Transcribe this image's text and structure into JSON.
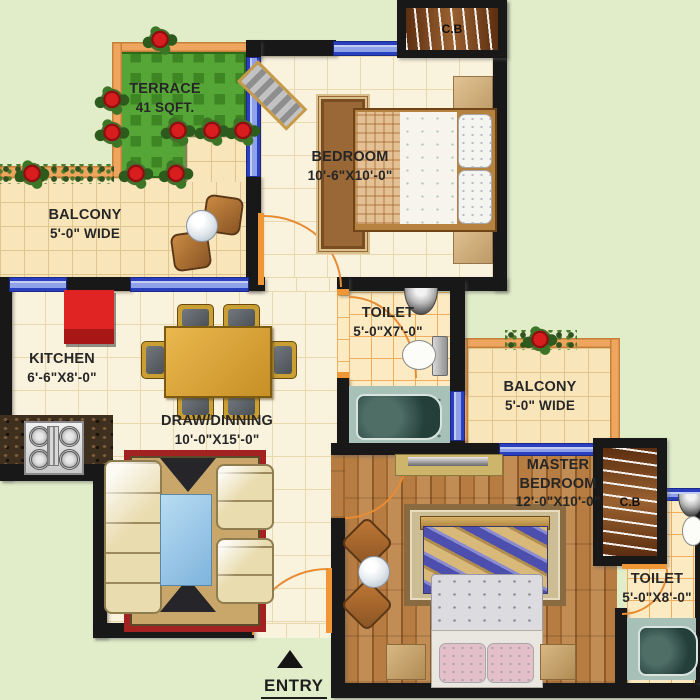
{
  "title": "apartment-floor-plan",
  "colors": {
    "background": "#e1edc9",
    "wall": "#181818",
    "outer_wall_orange": "#f0a55e",
    "window_blue": "#2a3fbe",
    "door_swing_orange": "#e88c34",
    "grass_green": "#56a637",
    "carpet_red_border": "#a32121",
    "floor_cream": "#f9f2dd",
    "wood_floor": "#b67c41"
  },
  "rooms": {
    "terrace": {
      "name": "TERRACE",
      "size": "41 SQFT."
    },
    "balcony_left": {
      "name": "BALCONY",
      "size": "5'-0\" WIDE"
    },
    "bedroom": {
      "name": "BEDROOM",
      "size": "10'-6\"X10'-0\""
    },
    "toilet_top": {
      "name": "TOILET",
      "size": "5'-0\"X7'-0\""
    },
    "kitchen": {
      "name": "KITCHEN",
      "size": "6'-6\"X8'-0\""
    },
    "draw_dining": {
      "name": "DRAW/DINNING",
      "size": "10'-0\"X15'-0\""
    },
    "balcony_right": {
      "name": "BALCONY",
      "size": "5'-0\" WIDE"
    },
    "master_bedroom": {
      "name": "MASTER BEDROOM",
      "size": "12'-0\"X10'-0\""
    },
    "toilet_bottom": {
      "name": "TOILET",
      "size": "5'-0\"X8'-0\""
    }
  },
  "closets": {
    "top": {
      "label": "C.B"
    },
    "right": {
      "label": "C.B"
    }
  },
  "entry": {
    "label": "ENTRY"
  }
}
